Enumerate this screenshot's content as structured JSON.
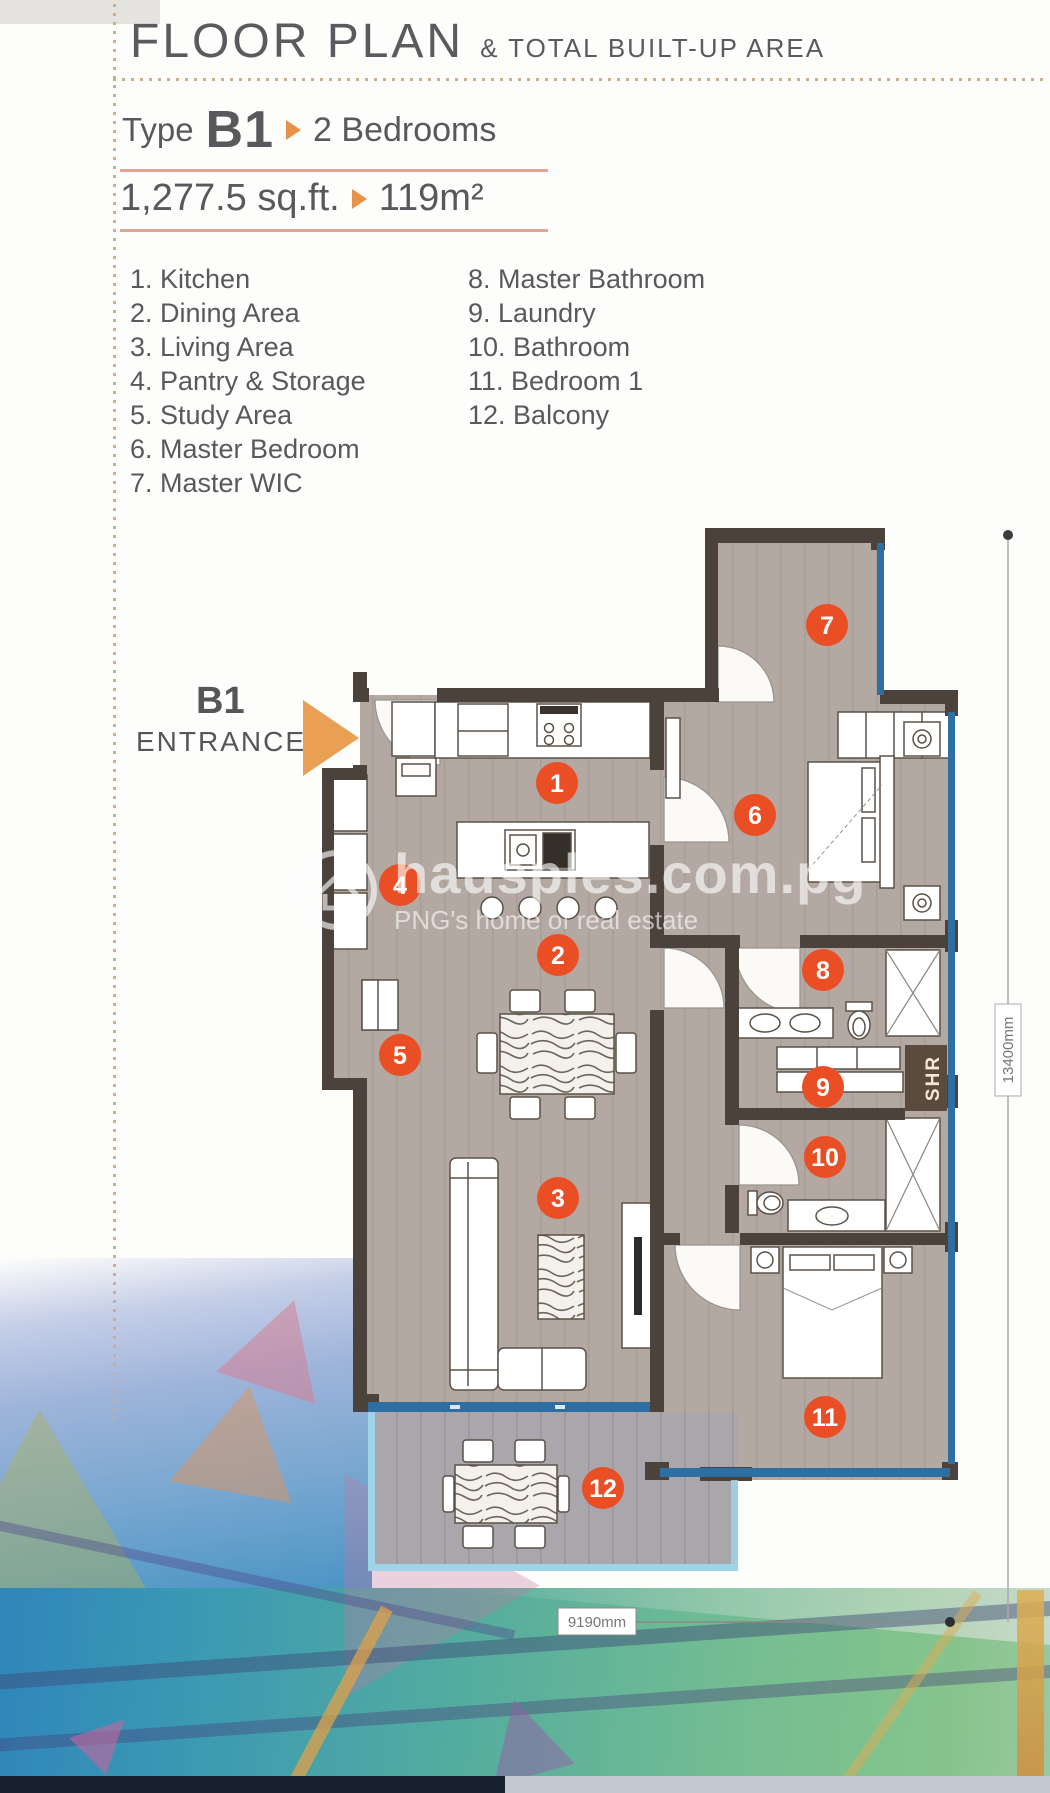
{
  "header": {
    "title": "FLOOR PLAN",
    "subtitle": "& TOTAL BUILT-UP AREA"
  },
  "unit": {
    "type_label": "Type",
    "type_code": "B1",
    "bedrooms_label": "2 Bedrooms",
    "area_imperial": "1,277.5 sq.ft.",
    "area_metric": "119m²"
  },
  "legend": {
    "column1": [
      {
        "num": "1. ",
        "label": "Kitchen"
      },
      {
        "num": "2. ",
        "label": "Dining Area"
      },
      {
        "num": "3. ",
        "label": "Living Area"
      },
      {
        "num": "4. ",
        "label": "Pantry & Storage"
      },
      {
        "num": "5. ",
        "label": "Study Area"
      },
      {
        "num": "6. ",
        "label": "Master Bedroom"
      },
      {
        "num": "7. ",
        "label": "Master WIC"
      }
    ],
    "column2": [
      {
        "num": "8. ",
        "label": "Master Bathroom"
      },
      {
        "num": "9. ",
        "label": "Laundry"
      },
      {
        "num": "10. ",
        "label": "Bathroom"
      },
      {
        "num": "11. ",
        "label": "Bedroom 1"
      },
      {
        "num": "12. ",
        "label": "Balcony"
      }
    ]
  },
  "entrance": {
    "code": "B1",
    "label": "ENTRANCE"
  },
  "plan": {
    "room_numbers": [
      "1",
      "2",
      "3",
      "4",
      "5",
      "6",
      "7",
      "8",
      "9",
      "10",
      "11",
      "12"
    ],
    "shr_label": "SHR",
    "dimension_width": "9190mm",
    "dimension_height": "13400mm"
  },
  "watermark": {
    "domain": "hausples.com.pg",
    "tagline": "PNG's home of real estate"
  },
  "colors": {
    "accent_orange": "#e8914a",
    "marker_red": "#e94e24",
    "wall_brown": "#4b423b",
    "floor_tan": "#b4a9a2",
    "window_blue": "#2d6fa3",
    "balcony_rail_blue": "#9fd4e8",
    "shr_brown": "#5b4b3c"
  }
}
